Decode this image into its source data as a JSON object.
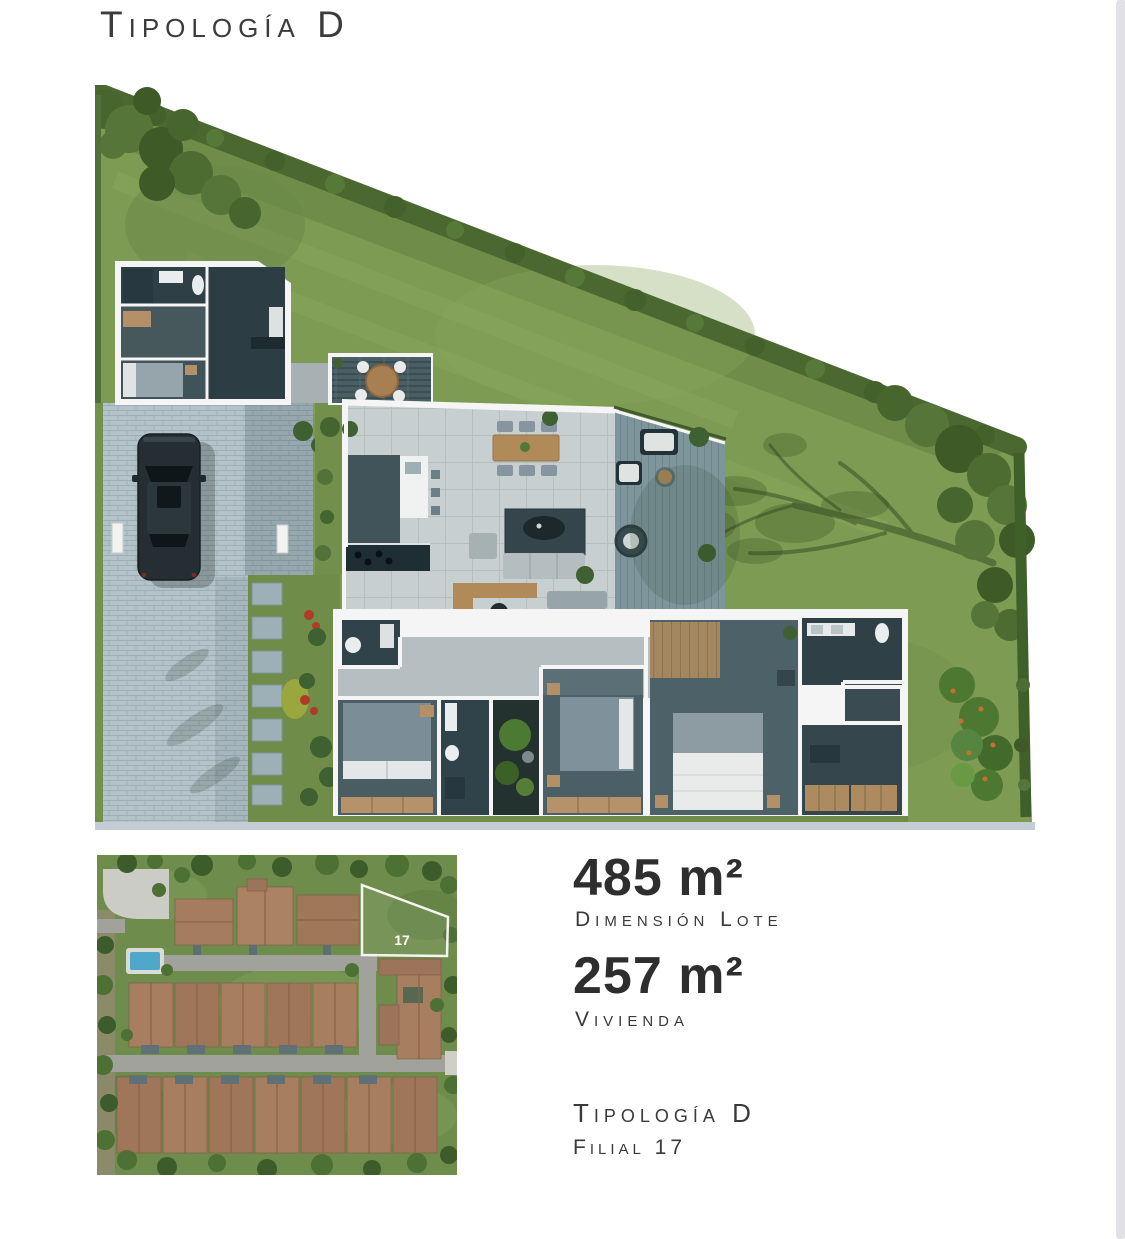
{
  "page": {
    "background": "#ffffff",
    "text_color": "#3a3a3a",
    "scrollbar_color": "#e0e0e6"
  },
  "header": {
    "title": "Tipología D"
  },
  "specs": [
    {
      "value": "485 m²",
      "label": "Dimensión Lote"
    },
    {
      "value": "257 m²",
      "label": "Vivienda"
    }
  ],
  "footer": {
    "typology": "Tipología D",
    "filial": "Filial 17"
  },
  "floor_plan": {
    "description": "Aerial 3D render of triangular lot with single-storey house, driveway, car and perimeter hedge",
    "colors": {
      "grass": "#7d9b52",
      "hedge": "#4a682f",
      "floor_light": "#c8cfd1",
      "floor_dark": "#3b4f55",
      "deck": "#7e959c",
      "wood": "#b08a58",
      "pavers": "#b4c3c9",
      "car": "#252e33"
    }
  },
  "site_map": {
    "lot_label": "17",
    "colors": {
      "grass": "#6e8c4c",
      "road": "#a0a29b",
      "roof": "#a57c5f",
      "pool": "#4fa8c9",
      "highlight": "#f5f5ef"
    }
  }
}
